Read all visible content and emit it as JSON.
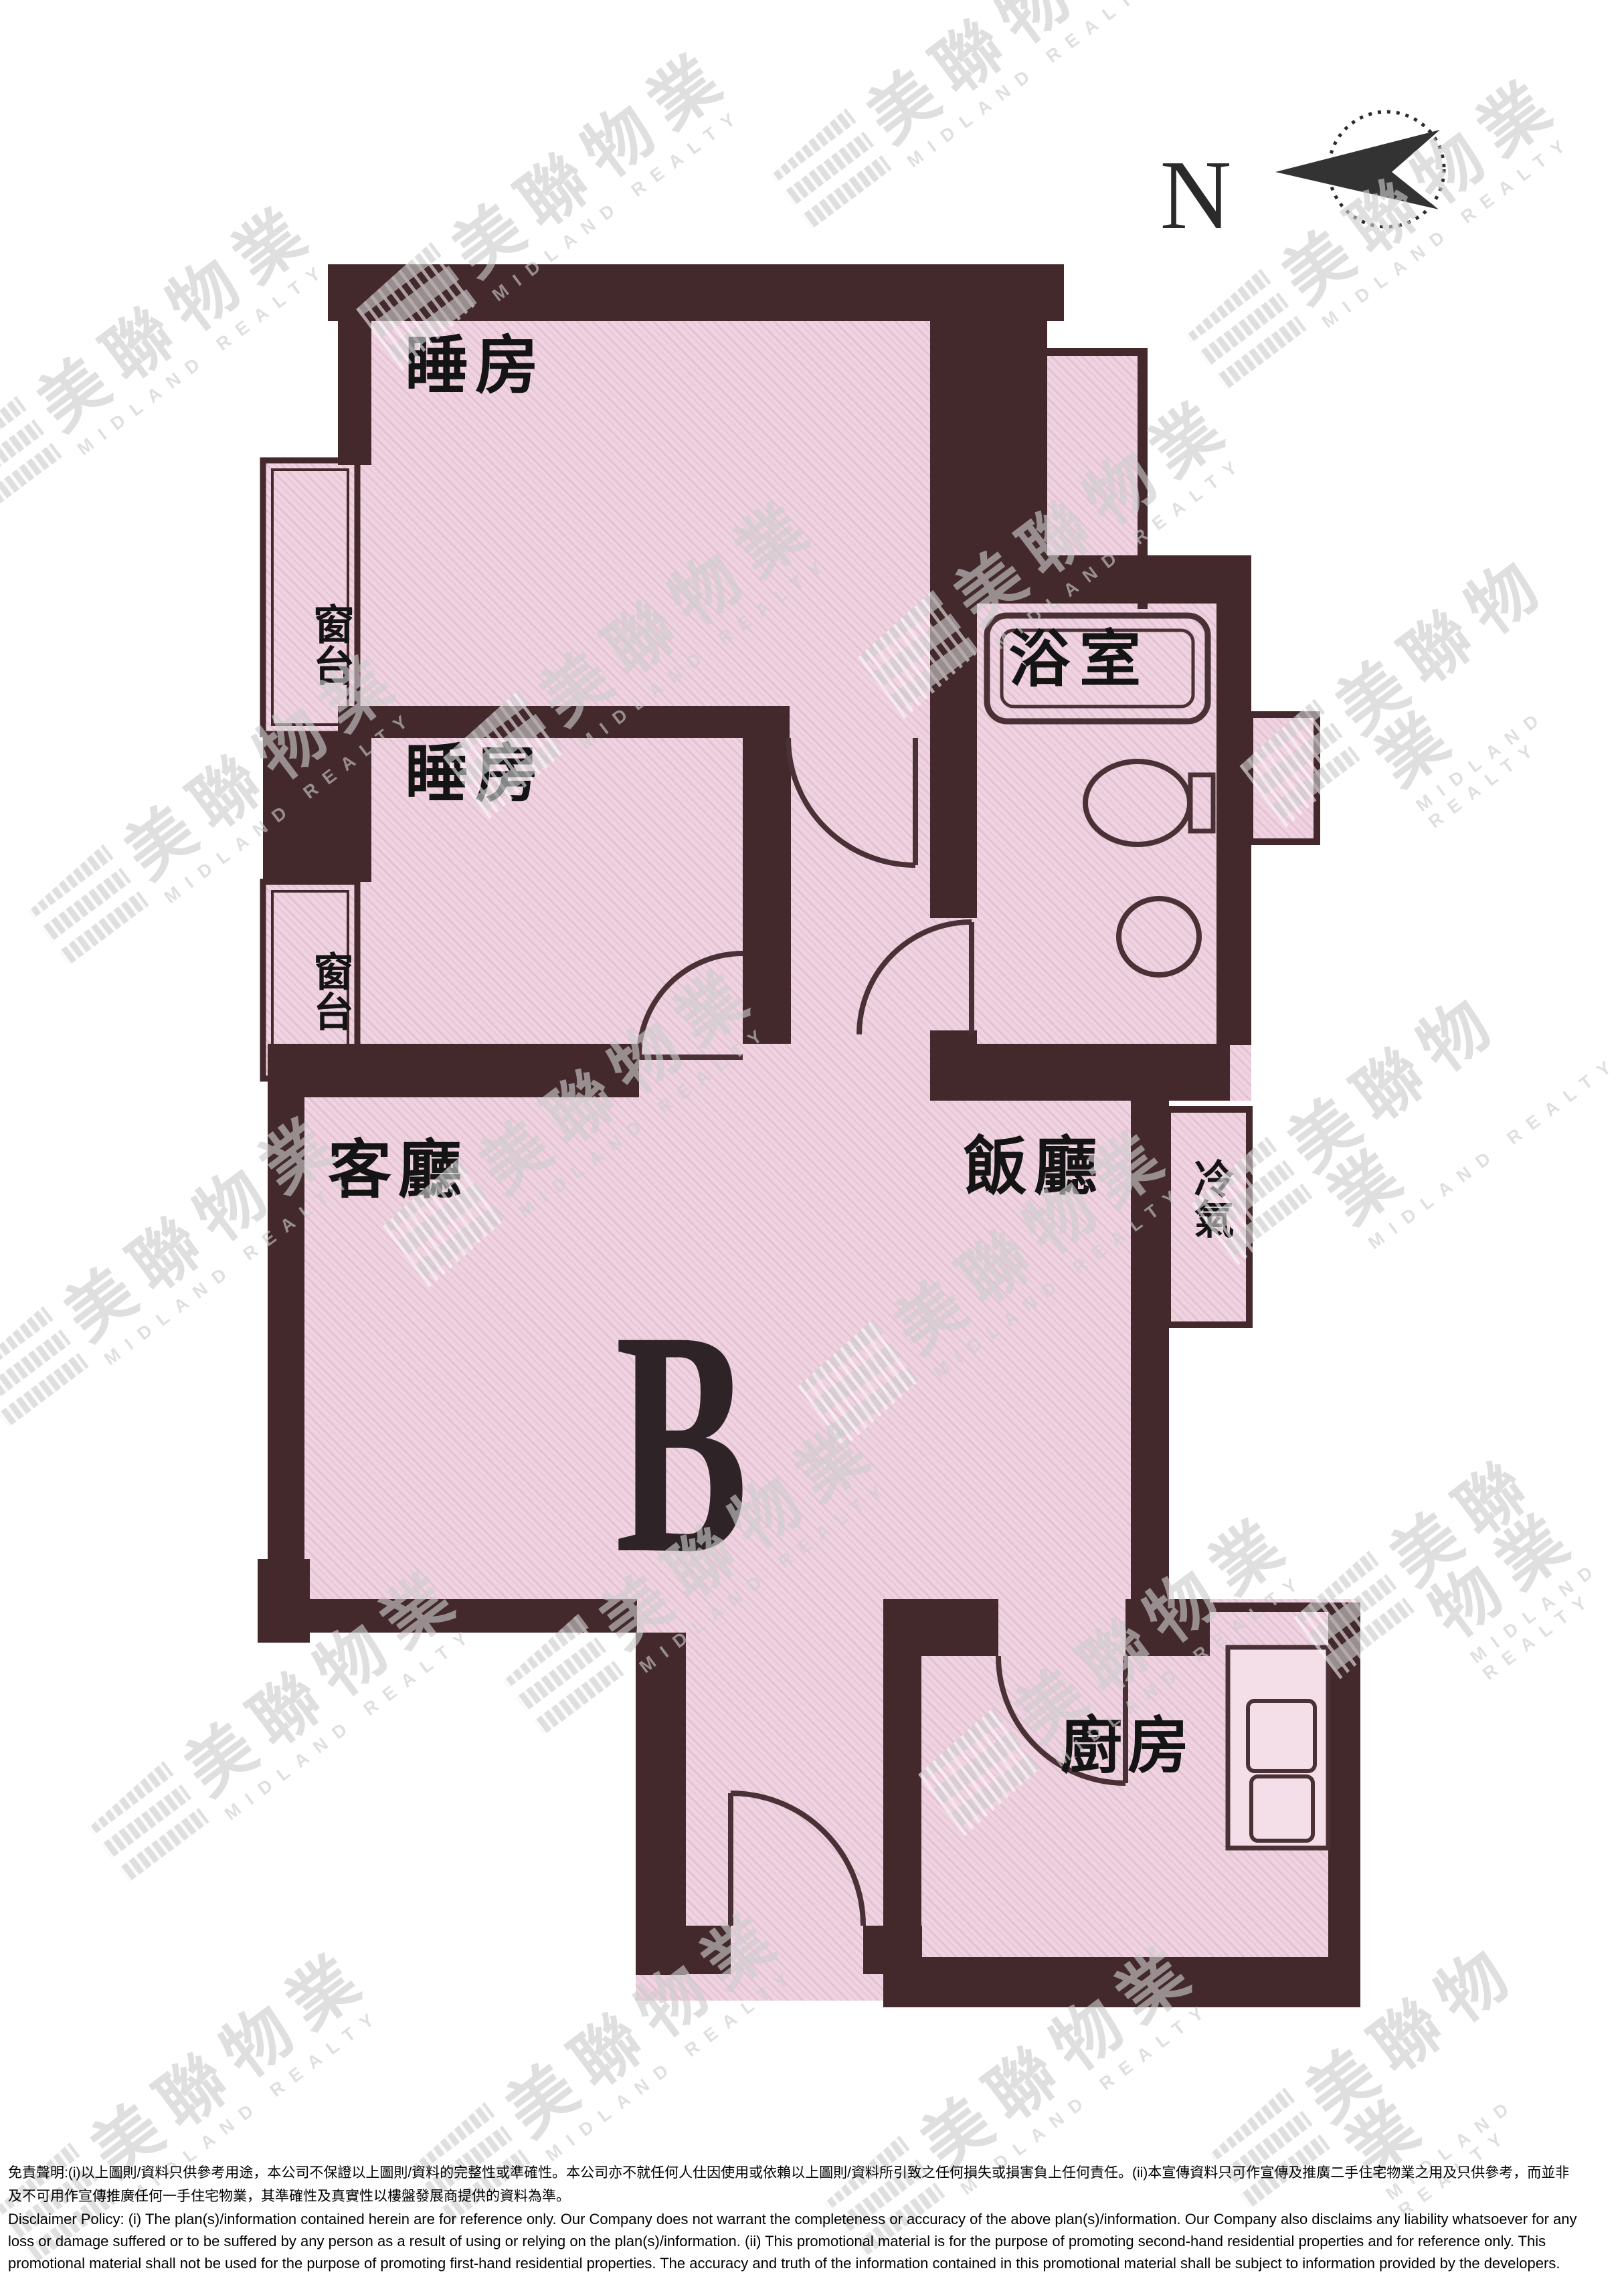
{
  "compass": {
    "label": "N"
  },
  "unit": {
    "label": "B"
  },
  "rooms": {
    "bedroom1": "睡房",
    "bedroom2": "睡房",
    "bay_window1": "窗台",
    "bay_window2": "窗台",
    "bathroom": "浴室",
    "living_room": "客廳",
    "dining_room": "飯廳",
    "ac_platform": "冷氣",
    "kitchen": "廚房"
  },
  "watermark": {
    "chinese": "美聯物業",
    "english": "MIDLAND REALTY"
  },
  "colors": {
    "wall": "#43282c",
    "room_fill": "#efd3e0",
    "room_hatch": "#e0bccf",
    "fixture_line": "#4a3136",
    "watermark_gray": "#cdcdcd"
  },
  "disclaimer": {
    "zh_line1": "免責聲明:(i)以上圖則/資料只供參考用途，本公司不保證以上圖則/資料的完整性或準確性。本公司亦不就任何人仕因使用或依賴以上圖則/資料所引致之任何損失或損害負上任何責任。(ii)本宣傳資料只可作宣傳及推廣二手住宅物業之用及只供參考，而並非",
    "zh_line2": "及不可用作宣傳推廣任何一手住宅物業，其準確性及真實性以樓盤發展商提供的資料為準。",
    "en_line1": "Disclaimer Policy: (i) The plan(s)/information contained herein are for reference only. Our Company does not warrant the completeness or accuracy of the above plan(s)/information. Our Company also disclaims any liability whatsoever for any",
    "en_line2": "loss or damage suffered or to be suffered by any person as a result of using or relying on the plan(s)/information. (ii) This promotional material is for the purpose of promoting second-hand residential properties and for reference only. This",
    "en_line3": "promotional material shall not be used for the purpose of promoting first-hand residential properties. The accuracy and truth of the information contained in this promotional material shall be subject to information provided by the developers."
  }
}
